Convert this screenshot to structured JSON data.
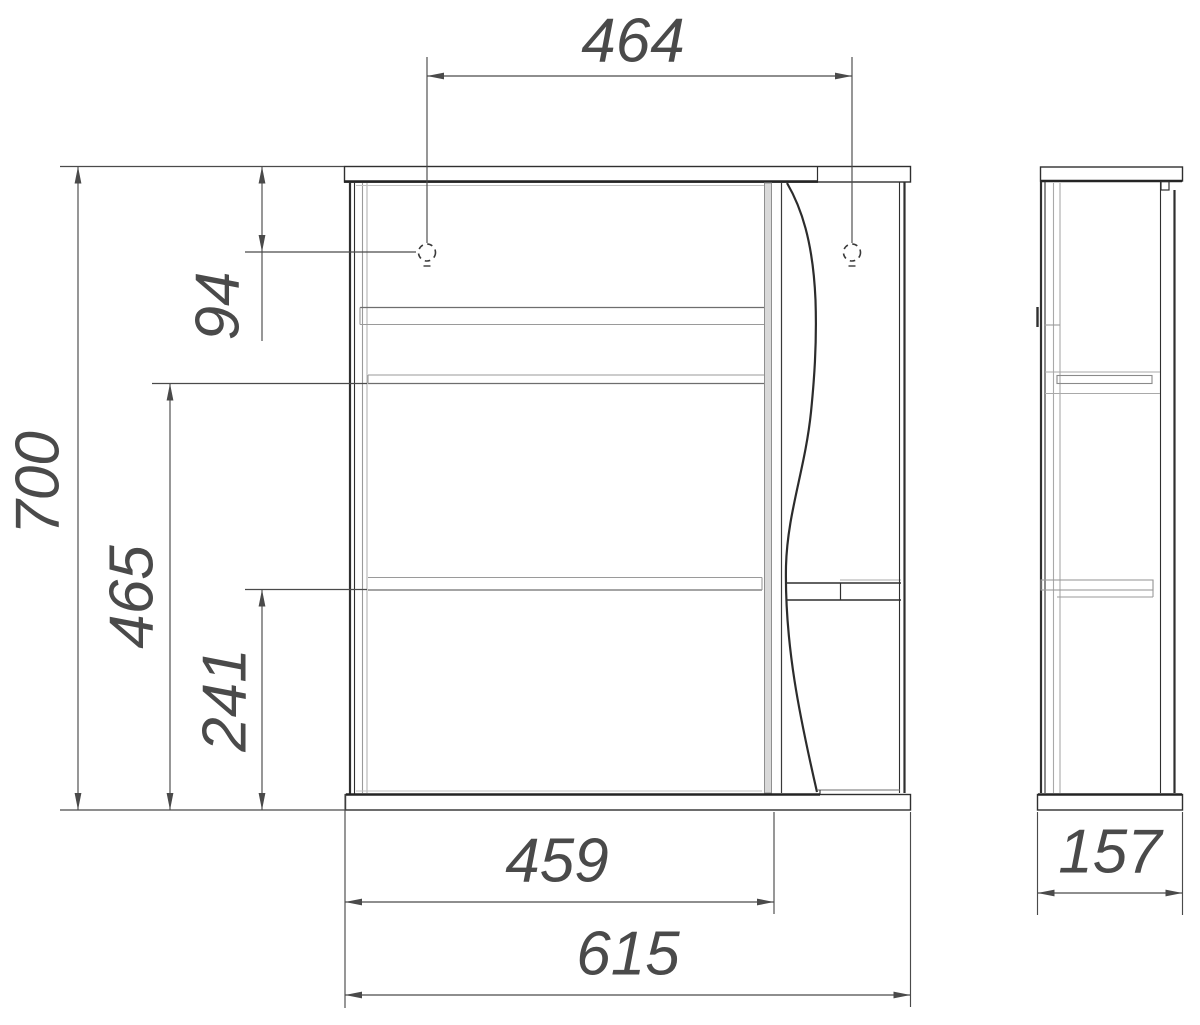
{
  "drawing": {
    "type": "technical-dimension-drawing",
    "subject": "wall-cabinet-with-mirror-door",
    "views": [
      "front-view",
      "side-view"
    ],
    "colors": {
      "background": "#ffffff",
      "outline_dark": "#2f2f2f",
      "line_light": "#a9a9a9",
      "door_edge_fill": "#d9d9d9",
      "dimension": "#4a4a4a"
    }
  },
  "dimensions": {
    "hole_spacing_top": "464",
    "holes_from_top": "94",
    "overall_height": "700",
    "middle_shelf_from_bottom": "465",
    "lower_shelf_from_bottom": "241",
    "door_width": "459",
    "overall_width": "615",
    "side_depth": "157"
  }
}
